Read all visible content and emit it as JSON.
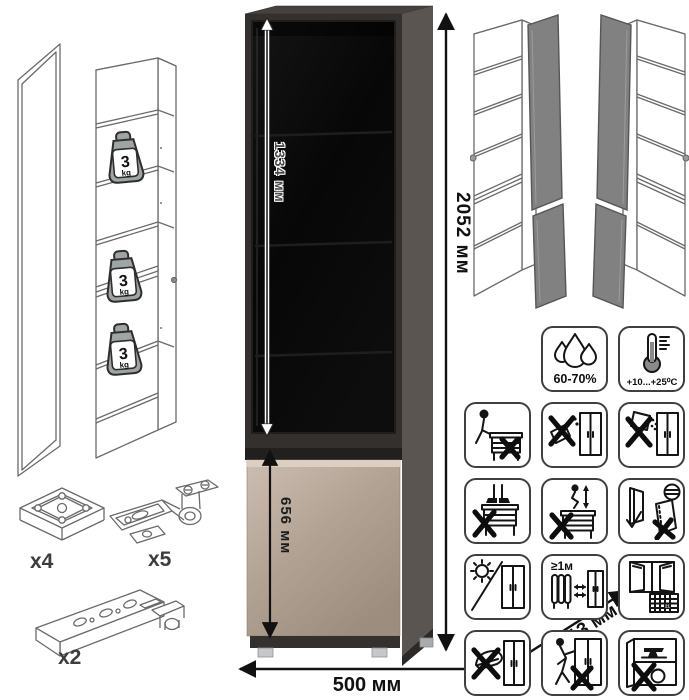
{
  "dimensions": {
    "glass_door_height": "1334 мм",
    "lower_door_height": "656 мм",
    "total_height": "2052 мм",
    "width": "500 мм",
    "depth": "413 мм"
  },
  "shelf_load": {
    "value": "3",
    "unit": "kg"
  },
  "hardware": {
    "foot": {
      "label": "x4"
    },
    "hinge": {
      "label": "x5"
    },
    "rail": {
      "label": "x2"
    }
  },
  "care": {
    "humidity": "60-70%",
    "temperature": "+10...+25⁰C",
    "heater_distance": "≥1м",
    "calendar_day": "21"
  },
  "icons": [
    "humidity-60-70-icon",
    "temperature-range-icon",
    "no-sitting-icon",
    "no-liquids-icon",
    "no-abrasives-icon",
    "no-standing-icon",
    "no-jumping-icon",
    "door-handling-icon",
    "no-direct-sunlight-icon",
    "heater-distance-icon",
    "room-ventilation-icon",
    "no-impact-icon",
    "no-dragging-icon",
    "no-overload-icon"
  ],
  "colors": {
    "carcass_dark": "#34302d",
    "side_panel": "#5b5551",
    "glass": "#0a0a0a",
    "front_beige": "#b2a294",
    "open_door_gray": "#818181"
  }
}
